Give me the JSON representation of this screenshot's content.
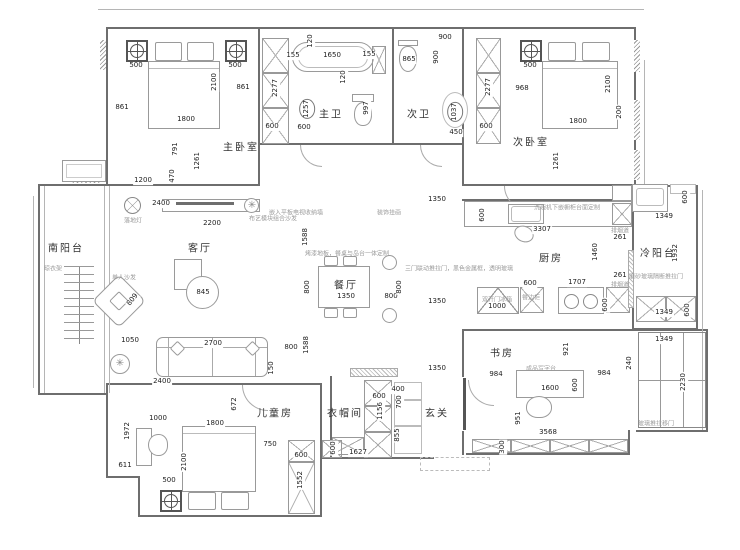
{
  "type": "apartment-floor-plan",
  "colors": {
    "background": "#ffffff",
    "wall": "#6e6e6e",
    "line": "#9a9a9a",
    "dimension_text": "#222222",
    "room_text": "#333333",
    "annotation_text": "#9a9a9a"
  },
  "rooms": [
    {
      "t": "主卧室",
      "x": 241,
      "y": 146
    },
    {
      "t": "次卧室",
      "x": 531,
      "y": 141
    },
    {
      "t": "主卫",
      "x": 331,
      "y": 113
    },
    {
      "t": "次卫",
      "x": 419,
      "y": 113
    },
    {
      "t": "南阳台",
      "x": 66,
      "y": 247
    },
    {
      "t": "客厅",
      "x": 200,
      "y": 247
    },
    {
      "t": "餐厅",
      "x": 346,
      "y": 284
    },
    {
      "t": "厨房",
      "x": 551,
      "y": 257
    },
    {
      "t": "冷阳台",
      "x": 658,
      "y": 252
    },
    {
      "t": "书房",
      "x": 502,
      "y": 352
    },
    {
      "t": "儿童房",
      "x": 275,
      "y": 412
    },
    {
      "t": "衣帽间",
      "x": 345,
      "y": 412
    },
    {
      "t": "玄关",
      "x": 437,
      "y": 412
    }
  ],
  "dimensions": [
    {
      "t": "500",
      "x": 136,
      "y": 66
    },
    {
      "t": "500",
      "x": 235,
      "y": 66
    },
    {
      "t": "861",
      "x": 122,
      "y": 108
    },
    {
      "t": "861",
      "x": 243,
      "y": 88
    },
    {
      "t": "2100",
      "x": 215,
      "y": 82,
      "r": 1
    },
    {
      "t": "1800",
      "x": 186,
      "y": 120
    },
    {
      "t": "791",
      "x": 176,
      "y": 149,
      "r": 1
    },
    {
      "t": "1261",
      "x": 198,
      "y": 161,
      "r": 1
    },
    {
      "t": "1200",
      "x": 143,
      "y": 181
    },
    {
      "t": "470",
      "x": 173,
      "y": 176,
      "r": 1
    },
    {
      "t": "2277",
      "x": 276,
      "y": 88,
      "r": 1
    },
    {
      "t": "600",
      "x": 272,
      "y": 127
    },
    {
      "t": "155",
      "x": 293,
      "y": 56
    },
    {
      "t": "1650",
      "x": 332,
      "y": 56
    },
    {
      "t": "155",
      "x": 369,
      "y": 55
    },
    {
      "t": "120",
      "x": 311,
      "y": 41,
      "r": 1
    },
    {
      "t": "120",
      "x": 344,
      "y": 77,
      "r": 1
    },
    {
      "t": "1257",
      "x": 307,
      "y": 109,
      "r": 1,
      "c": 1
    },
    {
      "t": "600",
      "x": 304,
      "y": 128
    },
    {
      "t": "997",
      "x": 367,
      "y": 108,
      "r": 1
    },
    {
      "t": "865",
      "x": 409,
      "y": 60
    },
    {
      "t": "900",
      "x": 445,
      "y": 38
    },
    {
      "t": "900",
      "x": 437,
      "y": 57,
      "r": 1
    },
    {
      "t": "1037",
      "x": 455,
      "y": 112,
      "r": 1,
      "c": 1
    },
    {
      "t": "450",
      "x": 456,
      "y": 133
    },
    {
      "t": "2277",
      "x": 489,
      "y": 87,
      "r": 1
    },
    {
      "t": "600",
      "x": 486,
      "y": 127
    },
    {
      "t": "500",
      "x": 530,
      "y": 66
    },
    {
      "t": "968",
      "x": 522,
      "y": 89
    },
    {
      "t": "2100",
      "x": 609,
      "y": 84,
      "r": 1
    },
    {
      "t": "1800",
      "x": 578,
      "y": 122
    },
    {
      "t": "200",
      "x": 620,
      "y": 112,
      "r": 1
    },
    {
      "t": "1261",
      "x": 557,
      "y": 161,
      "r": 1
    },
    {
      "t": "2400",
      "x": 161,
      "y": 204
    },
    {
      "t": "2200",
      "x": 212,
      "y": 224
    },
    {
      "t": "845",
      "x": 203,
      "y": 293
    },
    {
      "t": "809",
      "x": 133,
      "y": 300,
      "r": 2
    },
    {
      "t": "1050",
      "x": 130,
      "y": 341
    },
    {
      "t": "1588",
      "x": 306,
      "y": 237,
      "r": 1
    },
    {
      "t": "800",
      "x": 308,
      "y": 287,
      "r": 1
    },
    {
      "t": "1350",
      "x": 346,
      "y": 297
    },
    {
      "t": "800",
      "x": 391,
      "y": 297
    },
    {
      "t": "800",
      "x": 400,
      "y": 287,
      "r": 1
    },
    {
      "t": "1350",
      "x": 437,
      "y": 200
    },
    {
      "t": "1350",
      "x": 437,
      "y": 302
    },
    {
      "t": "600",
      "x": 483,
      "y": 215,
      "r": 1
    },
    {
      "t": "3307",
      "x": 542,
      "y": 230
    },
    {
      "t": "1460",
      "x": 596,
      "y": 252,
      "r": 1
    },
    {
      "t": "261",
      "x": 620,
      "y": 238
    },
    {
      "t": "261",
      "x": 620,
      "y": 276
    },
    {
      "t": "600",
      "x": 530,
      "y": 284
    },
    {
      "t": "1707",
      "x": 577,
      "y": 283
    },
    {
      "t": "1000",
      "x": 497,
      "y": 307
    },
    {
      "t": "600",
      "x": 606,
      "y": 305,
      "r": 1
    },
    {
      "t": "600",
      "x": 686,
      "y": 197,
      "r": 1
    },
    {
      "t": "1349",
      "x": 664,
      "y": 217
    },
    {
      "t": "1932",
      "x": 676,
      "y": 253,
      "r": 1
    },
    {
      "t": "1349",
      "x": 664,
      "y": 313
    },
    {
      "t": "600",
      "x": 688,
      "y": 310,
      "r": 1
    },
    {
      "t": "1349",
      "x": 664,
      "y": 340
    },
    {
      "t": "921",
      "x": 567,
      "y": 349,
      "r": 1
    },
    {
      "t": "240",
      "x": 630,
      "y": 363,
      "r": 1
    },
    {
      "t": "2230",
      "x": 684,
      "y": 382,
      "r": 1
    },
    {
      "t": "984",
      "x": 496,
      "y": 375
    },
    {
      "t": "984",
      "x": 604,
      "y": 374
    },
    {
      "t": "1600",
      "x": 550,
      "y": 389
    },
    {
      "t": "600",
      "x": 576,
      "y": 385,
      "r": 1
    },
    {
      "t": "951",
      "x": 519,
      "y": 418,
      "r": 1
    },
    {
      "t": "3568",
      "x": 548,
      "y": 433
    },
    {
      "t": "300",
      "x": 503,
      "y": 447,
      "r": 1
    },
    {
      "t": "1350",
      "x": 437,
      "y": 369
    },
    {
      "t": "400",
      "x": 398,
      "y": 390
    },
    {
      "t": "700",
      "x": 400,
      "y": 402,
      "r": 1
    },
    {
      "t": "600",
      "x": 379,
      "y": 397
    },
    {
      "t": "1156",
      "x": 381,
      "y": 411,
      "r": 1
    },
    {
      "t": "855",
      "x": 398,
      "y": 435,
      "r": 1
    },
    {
      "t": "600",
      "x": 334,
      "y": 448,
      "r": 1
    },
    {
      "t": "1627",
      "x": 358,
      "y": 453
    },
    {
      "t": "2700",
      "x": 213,
      "y": 344
    },
    {
      "t": "800",
      "x": 291,
      "y": 348
    },
    {
      "t": "1588",
      "x": 307,
      "y": 345,
      "r": 1
    },
    {
      "t": "150",
      "x": 272,
      "y": 368,
      "r": 1
    },
    {
      "t": "2400",
      "x": 162,
      "y": 382
    },
    {
      "t": "672",
      "x": 235,
      "y": 404,
      "r": 1
    },
    {
      "t": "1000",
      "x": 158,
      "y": 419
    },
    {
      "t": "1800",
      "x": 215,
      "y": 424
    },
    {
      "t": "1972",
      "x": 128,
      "y": 431,
      "r": 1
    },
    {
      "t": "750",
      "x": 270,
      "y": 445
    },
    {
      "t": "600",
      "x": 301,
      "y": 456
    },
    {
      "t": "611",
      "x": 125,
      "y": 466
    },
    {
      "t": "2100",
      "x": 185,
      "y": 462,
      "r": 1
    },
    {
      "t": "1552",
      "x": 301,
      "y": 480,
      "r": 1
    },
    {
      "t": "500",
      "x": 169,
      "y": 481
    }
  ],
  "annotations": [
    {
      "t": "嵌入平板电视收纳墙",
      "x": 296,
      "y": 212
    },
    {
      "t": "装饰挂画",
      "x": 389,
      "y": 212
    },
    {
      "t": "烤漆地板，餐桌与岛台一体定制",
      "x": 347,
      "y": 253
    },
    {
      "t": "三门联动推拉门，黑色金属框，透明玻璃",
      "x": 459,
      "y": 268
    },
    {
      "t": "双开门冰箱",
      "x": 497,
      "y": 299
    },
    {
      "t": "餐边柜",
      "x": 531,
      "y": 297
    },
    {
      "t": "洗碗机下嵌橱柜台面定制",
      "x": 567,
      "y": 207
    },
    {
      "t": "磨砂玻璃隔断推拉门",
      "x": 656,
      "y": 276
    },
    {
      "t": "成品写字台",
      "x": 541,
      "y": 368
    },
    {
      "t": "单人沙发",
      "x": 124,
      "y": 277
    },
    {
      "t": "布艺模块组合沙发",
      "x": 273,
      "y": 218
    },
    {
      "t": "落地灯",
      "x": 133,
      "y": 220
    },
    {
      "t": "晾衣架",
      "x": 53,
      "y": 268
    },
    {
      "t": "玻璃推拉移门",
      "x": 656,
      "y": 423
    },
    {
      "t": "排烟道",
      "x": 620,
      "y": 230
    },
    {
      "t": "排烟道",
      "x": 620,
      "y": 284
    }
  ]
}
